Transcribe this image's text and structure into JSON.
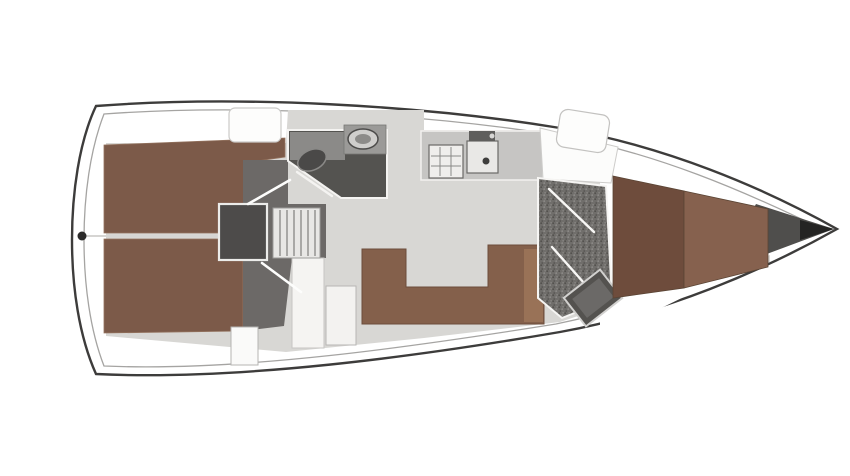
{
  "canvas": {
    "width": 850,
    "height": 476,
    "background": "#ffffff"
  },
  "palette": {
    "hull_stroke": "#3d3c3b",
    "deck_white": "#ffffff",
    "cabin_sole": "#d8d7d4",
    "berth_brown": "#7c5a49",
    "vberth_dark_brown": "#6e4c3c",
    "vberth_light_brown": "#86614e",
    "sofa_brown": "#84604b",
    "head_floor_dark": "#545350",
    "vestibule_gray": "#6c6967",
    "engine_gray": "#4d4b4a",
    "counter_gray": "#c6c5c3"
  },
  "diagram": {
    "kind": "sailboat-interior-floor-plan",
    "orientation": "bow-right",
    "shapes": [
      {
        "name": "hull-outline",
        "type": "path",
        "d": "M 96,106 C 240,95 420,105 560,128 C 665,146 762,187 837,229 C 762,271 665,313 560,332 C 420,356 240,381 96,374 C 79,336 72,287 72,240 C 72,193 79,142 96,106 Z",
        "fill": "#ffffff",
        "stroke": "#3d3c3b",
        "sw": 2.4
      },
      {
        "name": "hull-inner-rim",
        "type": "path",
        "d": "M 104,114 C 242,104 418,113 556,135 C 655,152 746,192 820,228 C 746,264 655,304 556,324 C 418,346 242,372 104,366 C 90,330 84,284 84,240 C 84,196 90,150 104,114 Z",
        "fill": "none",
        "stroke": "#a5a4a2",
        "sw": 1.3
      },
      {
        "name": "cabin-sole-floor",
        "type": "path",
        "d": "M 106,143 L 286,143 L 288,110 L 424,110 L 424,130 L 545,130 L 614,168 L 770,214 L 770,262 L 614,304 L 560,322 L 424,338 L 286,352 L 106,336 Z",
        "fill": "#d8d7d4"
      },
      {
        "name": "bow-deck",
        "type": "polygon",
        "points": "600,144 780,210 818,229 780,250 600,338",
        "fill": "#ffffff"
      },
      {
        "name": "bow-shadow",
        "type": "polygon",
        "points": "756,204 834,229 756,258 740,232",
        "fill": "#4f4e4c"
      },
      {
        "name": "bow-tip-shadow",
        "type": "polygon",
        "points": "800,220 834,229 800,240",
        "fill": "#242423"
      },
      {
        "name": "aft-cabin-berth-top",
        "type": "polygon",
        "points": "104,145 285,138 285,157 250,162 243,233 104,233",
        "fill": "#7c5a49",
        "stroke": "#94735f",
        "sw": 0.8
      },
      {
        "name": "aft-cabin-berth-bottom",
        "type": "polygon",
        "points": "104,239 243,239 243,331 104,333",
        "fill": "#7c5a49",
        "stroke": "#94735f",
        "sw": 0.8
      },
      {
        "name": "berth-seam-line",
        "type": "line",
        "x1": 84,
        "y1": 236,
        "x2": 243,
        "y2": 236,
        "stroke": "#d6d5d3",
        "sw": 2
      },
      {
        "name": "transom-fitting",
        "type": "circle",
        "cx": 82,
        "cy": 236,
        "r": 4.5,
        "fill": "#2c2b2a"
      },
      {
        "name": "companionway-vestibule",
        "type": "polygon",
        "points": "243,160 288,160 288,204 326,204 326,258 292,258 284,326 243,331",
        "fill": "#6c6967"
      },
      {
        "name": "lower-cabinet",
        "type": "rect",
        "x": 292,
        "y": 258,
        "w": 32,
        "h": 90,
        "fill": "#f5f4f2",
        "stroke": "#c6c5c3",
        "sw": 1
      },
      {
        "name": "nav-seat",
        "type": "rect",
        "x": 231,
        "y": 327,
        "w": 27,
        "h": 38,
        "fill": "#fafaf9",
        "stroke": "#b5b4b2",
        "sw": 1
      },
      {
        "name": "engine-box",
        "type": "rect",
        "x": 219,
        "y": 204,
        "w": 48,
        "h": 56,
        "fill": "#4d4b4a",
        "stroke": "#ececea",
        "sw": 2.2
      },
      {
        "name": "companionway-steps",
        "type": "rect",
        "x": 273,
        "y": 208,
        "w": 47,
        "h": 50,
        "fill": "#e8e7e5",
        "stroke": "#9c9b99",
        "sw": 1
      },
      {
        "name": "step-rung",
        "type": "line",
        "x1": 280,
        "y1": 210,
        "x2": 280,
        "y2": 256,
        "stroke": "#a9a8a6",
        "sw": 2
      },
      {
        "name": "step-rung",
        "type": "line",
        "x1": 287,
        "y1": 210,
        "x2": 287,
        "y2": 256,
        "stroke": "#a9a8a6",
        "sw": 2
      },
      {
        "name": "step-rung",
        "type": "line",
        "x1": 294,
        "y1": 210,
        "x2": 294,
        "y2": 256,
        "stroke": "#a9a8a6",
        "sw": 2
      },
      {
        "name": "step-rung",
        "type": "line",
        "x1": 301,
        "y1": 210,
        "x2": 301,
        "y2": 256,
        "stroke": "#a9a8a6",
        "sw": 2
      },
      {
        "name": "step-rung",
        "type": "line",
        "x1": 308,
        "y1": 210,
        "x2": 308,
        "y2": 256,
        "stroke": "#a9a8a6",
        "sw": 2
      },
      {
        "name": "step-rung",
        "type": "line",
        "x1": 315,
        "y1": 210,
        "x2": 315,
        "y2": 256,
        "stroke": "#a9a8a6",
        "sw": 2
      },
      {
        "name": "door-aft-cabin-top",
        "type": "line",
        "x1": 248,
        "y1": 204,
        "x2": 290,
        "y2": 180,
        "stroke": "#fdfdfc",
        "sw": 2.6,
        "cap": "round"
      },
      {
        "name": "door-aft-cabin-bottom",
        "type": "line",
        "x1": 262,
        "y1": 263,
        "x2": 301,
        "y2": 292,
        "stroke": "#fdfdfc",
        "sw": 2.6,
        "cap": "round"
      },
      {
        "name": "aft-head-room",
        "type": "polygon",
        "points": "288,130 387,130 387,198 341,198 288,161",
        "fill": "#545350",
        "stroke": "#f4f3f1",
        "sw": 2
      },
      {
        "name": "aft-head-counter",
        "type": "polygon",
        "points": "290,132 345,132 345,160 290,160",
        "fill": "#8b8a88"
      },
      {
        "name": "aft-head-sink-unit",
        "type": "rect",
        "x": 344,
        "y": 125,
        "w": 42,
        "h": 29,
        "fill": "#9b9a98",
        "stroke": "#777674",
        "sw": 0.8
      },
      {
        "name": "aft-head-sink",
        "type": "ellipse",
        "cx": 363,
        "cy": 139,
        "rx": 15,
        "ry": 10,
        "fill": "#cfcecc",
        "stroke": "#4c4b4a",
        "sw": 1.5
      },
      {
        "name": "aft-head-sink-bowl",
        "type": "ellipse",
        "cx": 363,
        "cy": 139,
        "rx": 8,
        "ry": 5,
        "fill": "#8c8b89"
      },
      {
        "name": "aft-head-toilet",
        "type": "ellipse",
        "cx": 312,
        "cy": 160,
        "rx": 15,
        "ry": 10,
        "fill": "#4a4948",
        "stroke": "#8a8987",
        "sw": 1.5,
        "transform": "rotate(-25 312 160)"
      },
      {
        "name": "door-aft-head",
        "type": "line",
        "x1": 297,
        "y1": 172,
        "x2": 332,
        "y2": 196,
        "stroke": "#f4f3f1",
        "sw": 2.4,
        "cap": "round"
      },
      {
        "name": "galley-counter",
        "type": "rect",
        "x": 421,
        "y": 131,
        "w": 122,
        "h": 49,
        "fill": "#c6c5c3",
        "stroke": "#f2f1ef",
        "sw": 1.5
      },
      {
        "name": "galley-stove",
        "type": "rect",
        "x": 429,
        "y": 145,
        "w": 34,
        "h": 33,
        "fill": "#efeeec",
        "stroke": "#6b6a68",
        "sw": 1.2
      },
      {
        "name": "stove-grid-line",
        "type": "line",
        "x1": 440,
        "y1": 147,
        "x2": 440,
        "y2": 176,
        "stroke": "#8a8987",
        "sw": 1
      },
      {
        "name": "stove-grid-line",
        "type": "line",
        "x1": 451,
        "y1": 147,
        "x2": 451,
        "y2": 176,
        "stroke": "#8a8987",
        "sw": 1
      },
      {
        "name": "stove-grid-line",
        "type": "line",
        "x1": 431,
        "y1": 156,
        "x2": 461,
        "y2": 156,
        "stroke": "#8a8987",
        "sw": 1
      },
      {
        "name": "stove-grid-line",
        "type": "line",
        "x1": 431,
        "y1": 166,
        "x2": 461,
        "y2": 166,
        "stroke": "#8a8987",
        "sw": 1
      },
      {
        "name": "galley-sink",
        "type": "rect",
        "x": 467,
        "y": 141,
        "w": 31,
        "h": 32,
        "fill": "#e9e8e6",
        "stroke": "#6b6a68",
        "sw": 1.2
      },
      {
        "name": "galley-sink-drain",
        "type": "circle",
        "cx": 486,
        "cy": 161,
        "r": 3.5,
        "fill": "#3e3d3c"
      },
      {
        "name": "galley-faucet",
        "type": "rect",
        "x": 469,
        "y": 131,
        "w": 26,
        "h": 10,
        "fill": "#5f5e5c"
      },
      {
        "name": "galley-faucet-knob",
        "type": "circle",
        "cx": 492,
        "cy": 136,
        "r": 2.5,
        "fill": "#d8d7d5"
      },
      {
        "name": "salon-table",
        "type": "rect",
        "x": 326,
        "y": 286,
        "w": 30,
        "h": 59,
        "fill": "#f3f2f0",
        "stroke": "#b7b6b4",
        "sw": 1
      },
      {
        "name": "dinette-sofa",
        "type": "polygon",
        "points": "362,249 406,249 406,287 488,287 488,245 544,245 544,324 362,324",
        "fill": "#84604b",
        "stroke": "#6b4c3b",
        "sw": 1
      },
      {
        "name": "dinette-sofa-end",
        "type": "rect",
        "x": 524,
        "y": 249,
        "w": 19,
        "h": 73,
        "fill": "#997257"
      },
      {
        "name": "companionway-garage",
        "type": "polygon",
        "points": "540,128 618,147 611,183 543,179",
        "fill": "#fcfcfb",
        "stroke": "#cdccca",
        "sw": 1
      },
      {
        "name": "deck-hatch-aft",
        "type": "rect",
        "x": 229,
        "y": 108,
        "w": 52,
        "h": 34,
        "rx": 6,
        "fill": "#fdfdfc",
        "stroke": "#cbcac8",
        "sw": 1.2
      },
      {
        "name": "deck-hatch-mid",
        "type": "rect",
        "x": 558,
        "y": 112,
        "w": 50,
        "h": 38,
        "rx": 8,
        "fill": "#fdfdfc",
        "stroke": "#c3c2c0",
        "sw": 1.2,
        "transform": "rotate(9 583 131)"
      },
      {
        "name": "fwd-head-room",
        "type": "polygon",
        "points": "538,178 606,186 612,298 562,318 538,298",
        "fill": "url(#speckle)",
        "stroke": "#f6f5f3",
        "sw": 2
      },
      {
        "name": "door-fwd-head-upper",
        "type": "line",
        "x1": 549,
        "y1": 189,
        "x2": 594,
        "y2": 232,
        "stroke": "#f8f7f5",
        "sw": 2.4,
        "cap": "round"
      },
      {
        "name": "door-fwd-head-lower",
        "type": "line",
        "x1": 552,
        "y1": 247,
        "x2": 592,
        "y2": 292,
        "stroke": "#f8f7f5",
        "sw": 2.4,
        "cap": "round"
      },
      {
        "name": "shower-tray",
        "type": "rect",
        "x": 570,
        "y": 280,
        "w": 46,
        "h": 36,
        "fill": "#54524f",
        "stroke": "#d2d1cf",
        "sw": 2,
        "transform": "rotate(-38 593 298)"
      },
      {
        "name": "shower-tray-inner",
        "type": "rect",
        "x": 576,
        "y": 286,
        "w": 34,
        "h": 24,
        "fill": "#6b6967",
        "transform": "rotate(-38 593 298)"
      },
      {
        "name": "vberth-mattress-left",
        "type": "polygon",
        "points": "613,176 684,191 684,288 613,298",
        "fill": "#6e4c3c",
        "stroke": "#5a4434",
        "sw": 0.8
      },
      {
        "name": "vberth-mattress-right",
        "type": "polygon",
        "points": "684,191 768,209 768,267 684,288",
        "fill": "#86614e",
        "stroke": "#5a4434",
        "sw": 0.8
      }
    ]
  }
}
